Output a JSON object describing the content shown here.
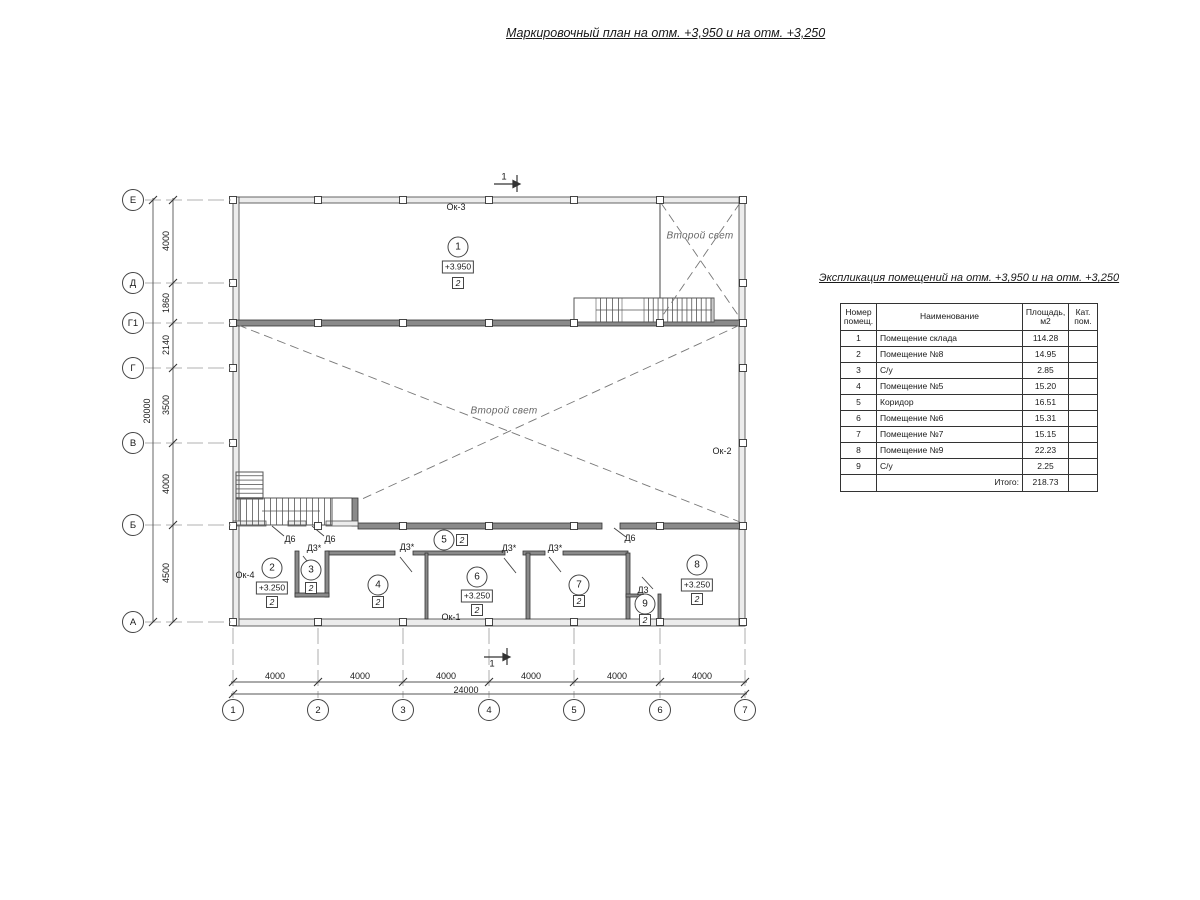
{
  "title": "Маркировочный план на отм. +3,950 и на отм. +3,250",
  "explication": {
    "title": "Экспликация помещений на отм. +3,950 и на отм. +3,250",
    "headers": [
      "Номер помещ.",
      "Наименование",
      "Площадь, м2",
      "Кат. пом."
    ],
    "rows": [
      {
        "num": "1",
        "name": "Помещение склада",
        "area": "114.28",
        "cat": ""
      },
      {
        "num": "2",
        "name": "Помещение №8",
        "area": "14.95",
        "cat": ""
      },
      {
        "num": "3",
        "name": "С/у",
        "area": "2.85",
        "cat": ""
      },
      {
        "num": "4",
        "name": "Помещение №5",
        "area": "15.20",
        "cat": ""
      },
      {
        "num": "5",
        "name": "Коридор",
        "area": "16.51",
        "cat": ""
      },
      {
        "num": "6",
        "name": "Помещение №6",
        "area": "15.31",
        "cat": ""
      },
      {
        "num": "7",
        "name": "Помещение №7",
        "area": "15.15",
        "cat": ""
      },
      {
        "num": "8",
        "name": "Помещение №9",
        "area": "22.23",
        "cat": ""
      },
      {
        "num": "9",
        "name": "С/у",
        "area": "2.25",
        "cat": ""
      }
    ],
    "total_label": "Итого:",
    "total_value": "218.73"
  },
  "axes": {
    "rows": [
      "Е",
      "Д",
      "Г1",
      "Г",
      "В",
      "Б",
      "А"
    ],
    "cols": [
      "1",
      "2",
      "3",
      "4",
      "5",
      "6",
      "7"
    ]
  },
  "dims": {
    "left": [
      "4000",
      "1860",
      "2140",
      "3500",
      "4000",
      "4500"
    ],
    "left_total": "20000",
    "bottom": [
      "4000",
      "4000",
      "4000",
      "4000",
      "4000",
      "4000"
    ],
    "bottom_total": "24000"
  },
  "section": {
    "top": "1",
    "bottom": "1"
  },
  "plan": {
    "second_light_upper": "Второй свет",
    "second_light_main": "Второй свет",
    "windows": {
      "ok1": "Ок-1",
      "ok2": "Ок-2",
      "ok3": "Ок-3",
      "ok4": "Ок-4"
    },
    "doors": {
      "d6a": "Д6",
      "d6b": "Д6",
      "d6c": "Д6",
      "d3sa": "Д3*",
      "d3sb": "Д3*",
      "d3sc": "Д3*",
      "d3sd": "Д3*",
      "d3": "Д3"
    },
    "rooms": [
      {
        "num": "1",
        "elev": "+3.950",
        "cat": "2"
      },
      {
        "num": "2",
        "elev": "+3.250",
        "cat": "2"
      },
      {
        "num": "3",
        "cat": "2"
      },
      {
        "num": "4",
        "cat": "2"
      },
      {
        "num": "5",
        "cat": "2"
      },
      {
        "num": "6",
        "elev": "+3.250",
        "cat": "2"
      },
      {
        "num": "7",
        "cat": "2"
      },
      {
        "num": "8",
        "elev": "+3.250",
        "cat": "2"
      },
      {
        "num": "9",
        "cat": "2"
      }
    ],
    "colors": {
      "line": "#444444",
      "wall_dark": "#8a8a8a",
      "wall_light": "#ececec",
      "dashed": "#777777"
    }
  }
}
